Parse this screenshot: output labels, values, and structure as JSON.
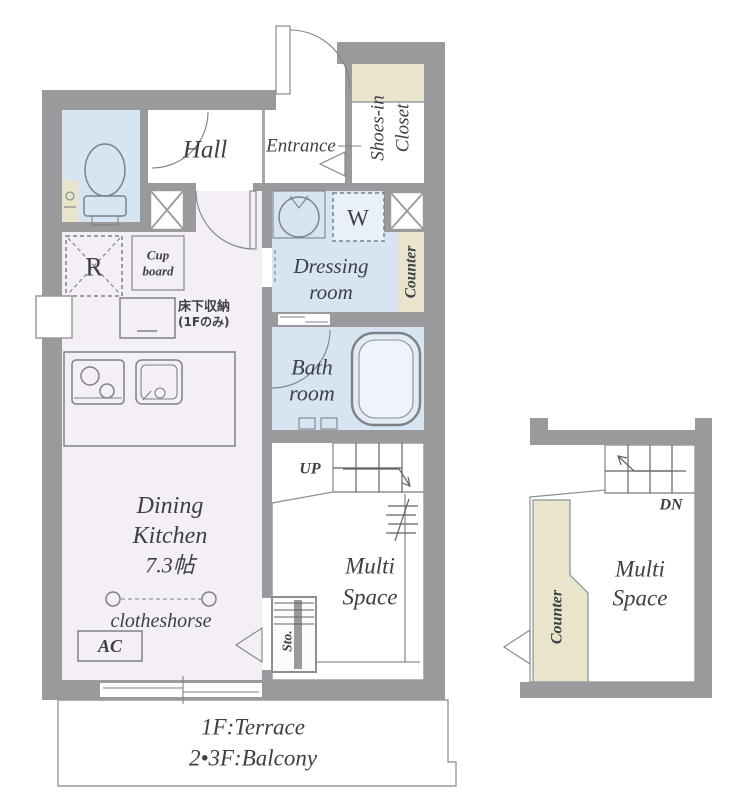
{
  "colors": {
    "wall": "#9a999b",
    "pink": "#f4eef5",
    "blue": "#d7e4f1",
    "beige": "#e9e5cc",
    "beige2": "#edecdc",
    "line": "#7d8289",
    "text": "#3d4046"
  },
  "main_plan": {
    "hall": {
      "label": "Hall"
    },
    "entrance": {
      "label": "Entrance"
    },
    "shoes_closet": {
      "line1": "Shoes-in",
      "line2": "Closet"
    },
    "washer_label": "W",
    "fridge_label": "R",
    "cupboard": {
      "line1": "Cup",
      "line2": "board"
    },
    "underfloor_storage": {
      "line1": "床下収納",
      "line2": "(1Fのみ)"
    },
    "dressing_room": {
      "line1": "Dressing",
      "line2": "room"
    },
    "counter_label": "Counter",
    "bath_room": {
      "line1": "Bath",
      "line2": "room"
    },
    "dining_kitchen": {
      "line1": "Dining",
      "line2": "Kitchen",
      "line3": "7.3帖"
    },
    "clotheshorse_label": "clotheshorse",
    "ac_label": "AC",
    "up_label": "UP",
    "multi_space": {
      "line1": "Multi",
      "line2": "Space"
    },
    "storage_label": "Sto.",
    "terrace": {
      "line1": "1F:Terrace",
      "line2": "2•3F:Balcony"
    }
  },
  "mini_plan": {
    "dn_label": "DN",
    "multi_space": {
      "line1": "Multi",
      "line2": "Space"
    },
    "counter_label": "Counter"
  }
}
